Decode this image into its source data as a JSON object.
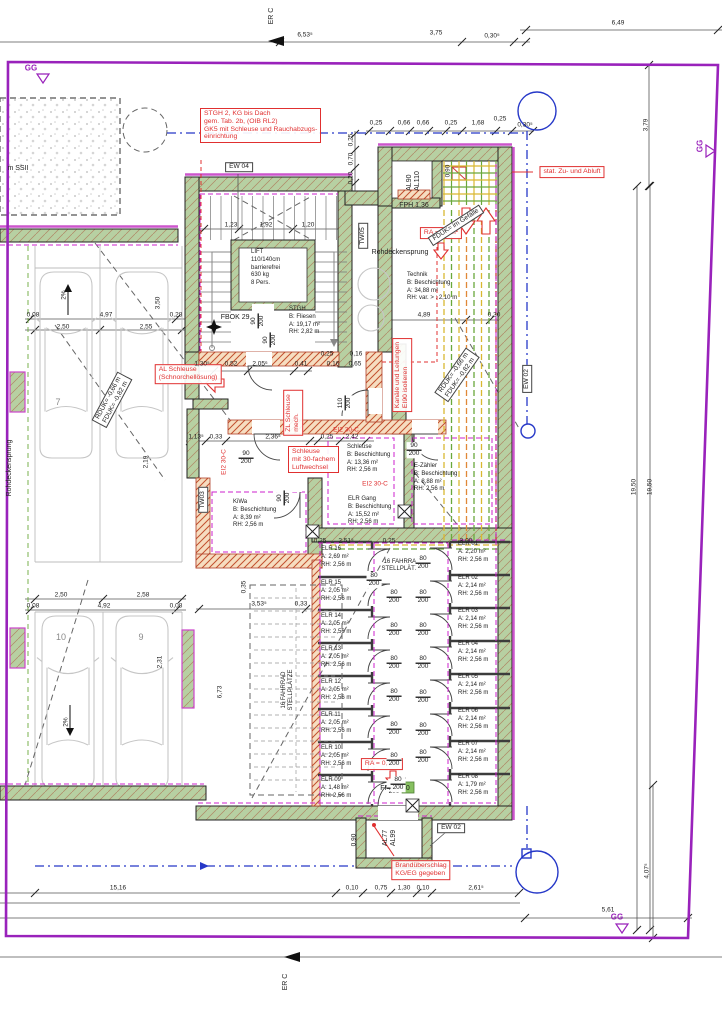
{
  "drawing_type": "Kellergeschoss Grundriss (basement floor plan)",
  "colors": {
    "boundary_purple": "#9922bb",
    "wall_green": "#b7d0a2",
    "annotation_red": "#e03030",
    "insulation_magenta": "#cc22cc",
    "duct_yellow": "#d9b832",
    "duct_green": "#6aa83c",
    "utility_blue": "#2638c8"
  },
  "labels": [
    {
      "id": "note-stgh2",
      "cls": "redbox",
      "a": "tl",
      "x": 200,
      "y": 108,
      "text": "STGH 2, KG bis Dach\ngem. Tab. 2b, (OIB RL2)\nGK5 mit Schleuse und Rauchabzugs-\neinrichtung"
    },
    {
      "id": "note-zuluft",
      "cls": "redbox",
      "x": 572,
      "y": 172,
      "text": "stat. Zu- und Abluft"
    },
    {
      "id": "note-ra-1",
      "cls": "redbox",
      "x": 441,
      "y": 233,
      "text": "RA = 0,5m²"
    },
    {
      "id": "note-kanaele",
      "cls": "redbox",
      "x": 402,
      "y": 375,
      "r": -90,
      "text": "Kanäle und Leitungen\nEI90 isolieren"
    },
    {
      "id": "note-al-schleuse",
      "cls": "redbox",
      "x": 188,
      "y": 374,
      "text": "AL Schleuse\n(Schnorchellösung)"
    },
    {
      "id": "note-zl-schleuse",
      "cls": "redbox",
      "x": 293,
      "y": 413,
      "r": -90,
      "text": "ZL Schleuse\nmech."
    },
    {
      "id": "note-schleuse-30",
      "cls": "redbox",
      "a": "tl",
      "x": 288,
      "y": 446,
      "text": "Schleuse\nmit 30-fachem\nLuftwechsel"
    },
    {
      "id": "note-ra-2",
      "cls": "redbox",
      "x": 382,
      "y": 764,
      "text": "RA = 0,5m²"
    },
    {
      "id": "note-brand",
      "cls": "redbox",
      "x": 421,
      "y": 870,
      "text": "Brandüberschlag\nKG/EG gegeben"
    },
    {
      "id": "ei2-30c-1",
      "cls": "redtext",
      "x": 346,
      "y": 430,
      "text": "EI2 30-C"
    },
    {
      "id": "ei2-30c-2",
      "cls": "redtext",
      "x": 224,
      "y": 462,
      "r": -90,
      "text": "EI2 30-C"
    },
    {
      "id": "ei2-30c-3",
      "cls": "redtext",
      "x": 375,
      "y": 484,
      "text": "EI2 30-C"
    },
    {
      "id": "ew-04",
      "cls": "blackbox",
      "x": 239,
      "y": 167,
      "text": "EW 04"
    },
    {
      "id": "tw-05",
      "cls": "blackbox",
      "x": 363,
      "y": 236,
      "r": -90,
      "text": "TW05"
    },
    {
      "id": "tw-03",
      "cls": "blackbox",
      "x": 203,
      "y": 500,
      "r": -90,
      "text": "TW03"
    },
    {
      "id": "ew-02-right",
      "cls": "blackbox",
      "x": 527,
      "y": 379,
      "r": -90,
      "text": "EW 02"
    },
    {
      "id": "ew-02-bottom",
      "cls": "blackbox",
      "x": 451,
      "y": 828,
      "text": "EW 02"
    },
    {
      "id": "fduk-gefaelle",
      "cls": "blackbox",
      "x": 456,
      "y": 225,
      "r": -33,
      "text": "FDUK= im Gefälle"
    },
    {
      "id": "rduk-fduk-right",
      "cls": "blackbox",
      "x": 457,
      "y": 375,
      "r": -55,
      "text": "RDUK= -0,66 m\nFDUK= -0,82 m"
    },
    {
      "id": "rduk-fduk-left",
      "cls": "blackbox",
      "x": 112,
      "y": 400,
      "r": -62,
      "text": "RDUK= -0,66 m\nFDUK= -0,82 m"
    },
    {
      "id": "al90-al110",
      "cls": "txt",
      "x": 414,
      "y": 181,
      "r": -90,
      "text": "AL90\nAL110"
    },
    {
      "id": "al77-al99",
      "cls": "txt",
      "x": 390,
      "y": 838,
      "r": -90,
      "text": "AL77\nAL99"
    },
    {
      "id": "fph-136",
      "cls": "txt",
      "x": 414,
      "y": 206,
      "text": "FPH 1,36"
    },
    {
      "id": "fph-140",
      "cls": "txt",
      "x": 395,
      "y": 789,
      "text": "FPH 1,40"
    },
    {
      "id": "fbok",
      "cls": "txt",
      "x": 240,
      "y": 318,
      "text": "FBOK 29,38"
    },
    {
      "id": "rohdeckensprung-1",
      "cls": "txt",
      "x": 400,
      "y": 253,
      "text": "Rohdeckensprung"
    },
    {
      "id": "rohdeckensprung-2",
      "cls": "txt",
      "x": 10,
      "y": 468,
      "r": -90,
      "text": "Rohdeckensprung"
    },
    {
      "id": "m-ssii",
      "cls": "txt",
      "x": 18,
      "y": 169,
      "text": "m SSII"
    },
    {
      "id": "fahrrad-1",
      "cls": "small",
      "x": 402,
      "y": 566,
      "text": "16 FAHRRAD\nSTELLPLÄTZE"
    },
    {
      "id": "fahrrad-2",
      "cls": "small",
      "x": 288,
      "y": 690,
      "r": -90,
      "text": "16 FAHRRAD\nSTELLPLÄTZE"
    },
    {
      "id": "er-c-top",
      "cls": "txt",
      "x": 272,
      "y": 16,
      "r": -90,
      "text": "ER C"
    },
    {
      "id": "er-c-bottom",
      "cls": "txt",
      "x": 286,
      "y": 982,
      "r": -90,
      "text": "ER C"
    },
    {
      "id": "room-lift",
      "cls": "room",
      "a": "tl",
      "x": 251,
      "y": 249,
      "text": "LIFT\n110/140cm\nbarrierefrei\n630 kg\n8 Pers."
    },
    {
      "id": "room-stgh",
      "cls": "room",
      "a": "tl",
      "x": 289,
      "y": 306,
      "text": "STGH\nB: Fliesen\nA: 19,17 m²\nRH: 2,82 m"
    },
    {
      "id": "room-technik",
      "cls": "room",
      "a": "tl",
      "x": 407,
      "y": 272,
      "text": "Technik\nB: Beschichtung\nA: 34,88 m²\nRH: var. > : 2,10 m"
    },
    {
      "id": "room-schleuse",
      "cls": "room",
      "a": "tl",
      "x": 347,
      "y": 444,
      "text": "Schleuse\nB: Beschichtung\nA: 13,36 m²\nRH: 2,56 m"
    },
    {
      "id": "room-e-zaehler",
      "cls": "room",
      "a": "tl",
      "x": 414,
      "y": 463,
      "text": "E-Zähler\nB: Beschichtung\nA: 8,88 m²\nRH: 2,56 m"
    },
    {
      "id": "room-elr-gang",
      "cls": "room",
      "a": "tl",
      "x": 348,
      "y": 496,
      "text": "ELR Gang\nB: Beschichtung\nA: 15,52 m²\nRH: 2,56 m"
    },
    {
      "id": "room-kiwa",
      "cls": "room",
      "a": "tl",
      "x": 233,
      "y": 499,
      "text": "KiWa\nB: Beschichtung\nA: 8,39 m²\nRH: 2,56 m"
    },
    {
      "id": "room-elr16",
      "cls": "room",
      "a": "tl",
      "x": 321,
      "y": 546,
      "text": "ELR 16\nA: 2,69 m²\nRH: 2,56 m"
    },
    {
      "id": "room-elr15",
      "cls": "room",
      "a": "tl",
      "x": 321,
      "y": 580,
      "text": "ELR 15\nA: 2,05 m²\nRH: 2,56 m"
    },
    {
      "id": "room-elr14",
      "cls": "room",
      "a": "tl",
      "x": 321,
      "y": 613,
      "text": "ELR 14\nA: 2,05 m²\nRH: 2,56 m"
    },
    {
      "id": "room-elr13",
      "cls": "room",
      "a": "tl",
      "x": 321,
      "y": 646,
      "text": "ELR 13\nA: 2,05 m²\nRH: 2,56 m"
    },
    {
      "id": "room-elr12",
      "cls": "room",
      "a": "tl",
      "x": 321,
      "y": 679,
      "text": "ELR 12\nA: 2,05 m²\nRH: 2,56 m"
    },
    {
      "id": "room-elr11",
      "cls": "room",
      "a": "tl",
      "x": 321,
      "y": 712,
      "text": "ELR 11\nA: 2,05 m²\nRH: 2,56 m"
    },
    {
      "id": "room-elr10",
      "cls": "room",
      "a": "tl",
      "x": 321,
      "y": 745,
      "text": "ELR 10\nA: 2,05 m²\nRH: 2,56 m"
    },
    {
      "id": "room-elr09",
      "cls": "room",
      "a": "tl",
      "x": 321,
      "y": 777,
      "text": "ELR 09\nA: 1,48 m²\nRH: 2,56 m"
    },
    {
      "id": "room-elr01",
      "cls": "room",
      "a": "tl",
      "x": 458,
      "y": 541,
      "text": "ELR 01\nA: 2,20 m²\nRH: 2,56 m"
    },
    {
      "id": "room-elr02",
      "cls": "room",
      "a": "tl",
      "x": 458,
      "y": 575,
      "text": "ELR 02\nA: 2,14 m²\nRH: 2,56 m"
    },
    {
      "id": "room-elr03",
      "cls": "room",
      "a": "tl",
      "x": 458,
      "y": 608,
      "text": "ELR 03\nA: 2,14 m²\nRH: 2,56 m"
    },
    {
      "id": "room-elr04",
      "cls": "room",
      "a": "tl",
      "x": 458,
      "y": 641,
      "text": "ELR 04\nA: 2,14 m²\nRH: 2,56 m"
    },
    {
      "id": "room-elr05",
      "cls": "room",
      "a": "tl",
      "x": 458,
      "y": 674,
      "text": "ELR 05\nA: 2,14 m²\nRH: 2,56 m"
    },
    {
      "id": "room-elr06",
      "cls": "room",
      "a": "tl",
      "x": 458,
      "y": 708,
      "text": "ELR 06\nA: 2,14 m²\nRH: 2,56 m"
    },
    {
      "id": "room-elr07",
      "cls": "room",
      "a": "tl",
      "x": 458,
      "y": 741,
      "text": "ELR 07\nA: 2,14 m²\nRH: 2,56 m"
    },
    {
      "id": "room-elr08",
      "cls": "room",
      "a": "tl",
      "x": 458,
      "y": 774,
      "text": "ELR 08\nA: 1,79 m²\nRH: 2,56 m"
    },
    {
      "id": "door-lift",
      "cls": "door",
      "x": 258,
      "y": 321,
      "r": -90,
      "text": "90\n200"
    },
    {
      "id": "door-stgh",
      "cls": "door",
      "x": 270,
      "y": 340,
      "r": -90,
      "text": "90\n200"
    },
    {
      "id": "door-schleuse",
      "cls": "door",
      "x": 246,
      "y": 458,
      "text": "90\n200"
    },
    {
      "id": "door-ezaehler",
      "cls": "door",
      "x": 414,
      "y": 450,
      "text": "90\n200"
    },
    {
      "id": "door-technik",
      "cls": "door",
      "x": 345,
      "y": 403,
      "r": -90,
      "text": "110\n200"
    },
    {
      "id": "door-kiwa",
      "cls": "door",
      "x": 284,
      "y": 498,
      "r": -90,
      "text": "90\n200"
    },
    {
      "id": "door-elr16",
      "cls": "door",
      "x": 374,
      "y": 580,
      "text": "80\n200"
    },
    {
      "id": "door-l1",
      "cls": "door",
      "x": 394,
      "y": 597,
      "text": "80\n200"
    },
    {
      "id": "door-l2",
      "cls": "door",
      "x": 394,
      "y": 630,
      "text": "80\n200"
    },
    {
      "id": "door-l3",
      "cls": "door",
      "x": 394,
      "y": 663,
      "text": "80\n200"
    },
    {
      "id": "door-l4",
      "cls": "door",
      "x": 394,
      "y": 696,
      "text": "80\n200"
    },
    {
      "id": "door-l5",
      "cls": "door",
      "x": 394,
      "y": 729,
      "text": "80\n200"
    },
    {
      "id": "door-l6",
      "cls": "door",
      "x": 394,
      "y": 760,
      "text": "80\n200"
    },
    {
      "id": "door-l7",
      "cls": "door",
      "x": 394,
      "y": 788,
      "text": "80\n200"
    },
    {
      "id": "door-r1",
      "cls": "door",
      "x": 423,
      "y": 563,
      "text": "80\n200"
    },
    {
      "id": "door-r2",
      "cls": "door",
      "x": 423,
      "y": 597,
      "text": "80\n200"
    },
    {
      "id": "door-r3",
      "cls": "door",
      "x": 423,
      "y": 630,
      "text": "80\n200"
    },
    {
      "id": "door-r4",
      "cls": "door",
      "x": 423,
      "y": 663,
      "text": "80\n200"
    },
    {
      "id": "door-r5",
      "cls": "door",
      "x": 423,
      "y": 697,
      "text": "80\n200"
    },
    {
      "id": "door-r6",
      "cls": "door",
      "x": 423,
      "y": 730,
      "text": "80\n200"
    },
    {
      "id": "door-r7",
      "cls": "door",
      "x": 423,
      "y": 757,
      "text": "80\n200"
    },
    {
      "id": "door-elr09",
      "cls": "door",
      "x": 398,
      "y": 784,
      "text": "80\n200"
    },
    {
      "id": "dim-653",
      "cls": "dim",
      "x": 305,
      "y": 35,
      "text": "6,53⁵"
    },
    {
      "id": "dim-375",
      "cls": "dim",
      "x": 436,
      "y": 33,
      "text": "3,75"
    },
    {
      "id": "dim-030a",
      "cls": "dim",
      "x": 492,
      "y": 36,
      "text": "0,30⁵"
    },
    {
      "id": "dim-649",
      "cls": "dim",
      "x": 618,
      "y": 23,
      "text": "6,49"
    },
    {
      "id": "dim-025a",
      "cls": "dim",
      "x": 376,
      "y": 123,
      "text": "0,25"
    },
    {
      "id": "dim-066a",
      "cls": "dim",
      "x": 404,
      "y": 123,
      "text": "0,66"
    },
    {
      "id": "dim-066b",
      "cls": "dim",
      "x": 423,
      "y": 123,
      "text": "0,66"
    },
    {
      "id": "dim-025b",
      "cls": "dim",
      "x": 451,
      "y": 123,
      "text": "0,25"
    },
    {
      "id": "dim-168",
      "cls": "dim",
      "x": 478,
      "y": 123,
      "text": "1,68"
    },
    {
      "id": "dim-025c",
      "cls": "dim",
      "x": 500,
      "y": 119,
      "text": "0,25"
    },
    {
      "id": "dim-030b",
      "cls": "dim",
      "x": 525,
      "y": 125,
      "text": "0,30⁵"
    },
    {
      "id": "dim-379",
      "cls": "dim",
      "x": 646,
      "y": 125,
      "r": -90,
      "text": "3,79"
    },
    {
      "id": "dim-1950a",
      "cls": "dim",
      "x": 634,
      "y": 487,
      "r": -90,
      "text": "19,50"
    },
    {
      "id": "dim-1950b",
      "cls": "dim",
      "x": 650,
      "y": 487,
      "r": -90,
      "text": "19,50"
    },
    {
      "id": "dim-407",
      "cls": "dim",
      "x": 647,
      "y": 871,
      "r": -90,
      "text": "4,07⁵"
    },
    {
      "id": "dim-1516",
      "cls": "dim",
      "x": 118,
      "y": 888,
      "text": "15,16"
    },
    {
      "id": "dim-010a",
      "cls": "dim",
      "x": 352,
      "y": 888,
      "text": "0,10"
    },
    {
      "id": "dim-075",
      "cls": "dim",
      "x": 381,
      "y": 888,
      "text": "0,75"
    },
    {
      "id": "dim-130",
      "cls": "dim",
      "x": 404,
      "y": 888,
      "text": "1,30"
    },
    {
      "id": "dim-010b",
      "cls": "dim",
      "x": 423,
      "y": 888,
      "text": "0,10"
    },
    {
      "id": "dim-261",
      "cls": "dim",
      "x": 476,
      "y": 888,
      "text": "2,61⁵"
    },
    {
      "id": "dim-561",
      "cls": "dim",
      "x": 608,
      "y": 910,
      "text": "5,61"
    },
    {
      "id": "dim-008a",
      "cls": "dim",
      "x": 33,
      "y": 315,
      "text": "0,08"
    },
    {
      "id": "dim-497",
      "cls": "dim",
      "x": 106,
      "y": 315,
      "text": "4,97"
    },
    {
      "id": "dim-028",
      "cls": "dim",
      "x": 176,
      "y": 315,
      "text": "0,28"
    },
    {
      "id": "dim-250a",
      "cls": "dim",
      "x": 63,
      "y": 327,
      "text": "2,50"
    },
    {
      "id": "dim-255",
      "cls": "dim",
      "x": 146,
      "y": 327,
      "text": "2,55"
    },
    {
      "id": "dim-350",
      "cls": "dim",
      "x": 158,
      "y": 303,
      "r": -90,
      "text": "3,50"
    },
    {
      "id": "dim-250b",
      "cls": "dim",
      "x": 61,
      "y": 595,
      "text": "2,50"
    },
    {
      "id": "dim-258",
      "cls": "dim",
      "x": 143,
      "y": 595,
      "text": "2,58"
    },
    {
      "id": "dim-008b",
      "cls": "dim",
      "x": 33,
      "y": 606,
      "text": "0,08"
    },
    {
      "id": "dim-492",
      "cls": "dim",
      "x": 104,
      "y": 606,
      "text": "4,92"
    },
    {
      "id": "dim-008c",
      "cls": "dim",
      "x": 176,
      "y": 606,
      "text": "0,08"
    },
    {
      "id": "dim-231",
      "cls": "dim",
      "x": 160,
      "y": 662,
      "r": -90,
      "text": "2,31"
    },
    {
      "id": "dim-219",
      "cls": "dim",
      "x": 146,
      "y": 462,
      "r": -90,
      "text": "2,19"
    },
    {
      "id": "dim-1305",
      "cls": "dim",
      "x": 202,
      "y": 364,
      "text": "1,30⁵"
    },
    {
      "id": "dim-052",
      "cls": "dim",
      "x": 231,
      "y": 364,
      "text": "0,52"
    },
    {
      "id": "dim-2056",
      "cls": "dim",
      "x": 260,
      "y": 364,
      "text": "2,05⁶"
    },
    {
      "id": "dim-041",
      "cls": "dim",
      "x": 301,
      "y": 364,
      "text": "0,41"
    },
    {
      "id": "dim-016a",
      "cls": "dim",
      "x": 333,
      "y": 364,
      "text": "0,16"
    },
    {
      "id": "dim-065",
      "cls": "dim",
      "x": 355,
      "y": 364,
      "text": "0,65"
    },
    {
      "id": "dim-1135",
      "cls": "dim",
      "x": 196,
      "y": 437,
      "text": "1,13⁵"
    },
    {
      "id": "dim-033a",
      "cls": "dim",
      "x": 216,
      "y": 437,
      "text": "0,33"
    },
    {
      "id": "dim-2365",
      "cls": "dim",
      "x": 273,
      "y": 437,
      "text": "2,36⁵"
    },
    {
      "id": "dim-025d",
      "cls": "dim",
      "x": 327,
      "y": 437,
      "text": "0,25"
    },
    {
      "id": "dim-242",
      "cls": "dim",
      "x": 352,
      "y": 437,
      "text": "2,42"
    },
    {
      "id": "dim-025e",
      "cls": "dim",
      "x": 327,
      "y": 354,
      "text": "0,25"
    },
    {
      "id": "dim-016b",
      "cls": "dim",
      "x": 356,
      "y": 354,
      "text": "0,16"
    },
    {
      "id": "dim-489",
      "cls": "dim",
      "x": 424,
      "y": 315,
      "text": "4,89"
    },
    {
      "id": "dim-030c",
      "cls": "dim",
      "x": 494,
      "y": 315,
      "text": "0,30"
    },
    {
      "id": "dim-3535",
      "cls": "dim",
      "x": 259,
      "y": 604,
      "text": "3,53⁵"
    },
    {
      "id": "dim-033b",
      "cls": "dim",
      "x": 301,
      "y": 604,
      "text": "0,33"
    },
    {
      "id": "dim-673",
      "cls": "dim",
      "x": 220,
      "y": 692,
      "r": -90,
      "text": "6,73"
    },
    {
      "id": "dim-035",
      "cls": "dim",
      "x": 244,
      "y": 587,
      "r": -90,
      "text": "0,35"
    },
    {
      "id": "dim-123",
      "cls": "dim",
      "x": 231,
      "y": 225,
      "text": "1,23"
    },
    {
      "id": "dim-192",
      "cls": "dim",
      "x": 266,
      "y": 225,
      "text": "1,92"
    },
    {
      "id": "dim-120",
      "cls": "dim",
      "x": 308,
      "y": 225,
      "text": "1,20"
    },
    {
      "id": "dim-025f",
      "cls": "dim",
      "x": 351,
      "y": 140,
      "r": -90,
      "text": "0,25"
    },
    {
      "id": "dim-070",
      "cls": "dim",
      "x": 351,
      "y": 159,
      "r": -90,
      "text": "0,70"
    },
    {
      "id": "dim-020",
      "cls": "dim",
      "x": 351,
      "y": 178,
      "r": -90,
      "text": "0,20"
    },
    {
      "id": "dim-090a",
      "cls": "dim",
      "x": 448,
      "y": 171,
      "r": -90,
      "text": "0,90"
    },
    {
      "id": "dim-090b",
      "cls": "dim",
      "x": 354,
      "y": 840,
      "r": -90,
      "text": "0,90"
    },
    {
      "id": "dim-025g",
      "cls": "dim",
      "x": 320,
      "y": 541,
      "text": "0,25"
    },
    {
      "id": "dim-2515",
      "cls": "dim",
      "x": 346,
      "y": 541,
      "text": "2,51⁵"
    },
    {
      "id": "dim-025h",
      "cls": "dim",
      "x": 389,
      "y": 541,
      "text": "0,25"
    },
    {
      "id": "dim-300",
      "cls": "dim",
      "x": 466,
      "y": 541,
      "text": "3,00"
    },
    {
      "id": "slope-top",
      "cls": "dim",
      "x": 64,
      "y": 295,
      "r": -90,
      "text": "2%"
    },
    {
      "id": "slope-bottom",
      "cls": "dim",
      "x": 66,
      "y": 722,
      "r": -90,
      "text": "2%"
    },
    {
      "id": "stall-7",
      "cls": "num",
      "x": 58,
      "y": 402,
      "text": "7"
    },
    {
      "id": "stall-10",
      "cls": "num",
      "x": 61,
      "y": 637,
      "text": "10"
    },
    {
      "id": "stall-9",
      "cls": "num",
      "x": 141,
      "y": 637,
      "text": "9"
    },
    {
      "id": "gg-top-left",
      "cls": "gg",
      "x": 31,
      "y": 68,
      "text": "GG"
    },
    {
      "id": "gg-right",
      "cls": "gg",
      "x": 700,
      "y": 146,
      "r": -90,
      "text": "GG"
    },
    {
      "id": "gg-bottom",
      "cls": "gg",
      "x": 617,
      "y": 917,
      "text": "GG"
    }
  ]
}
